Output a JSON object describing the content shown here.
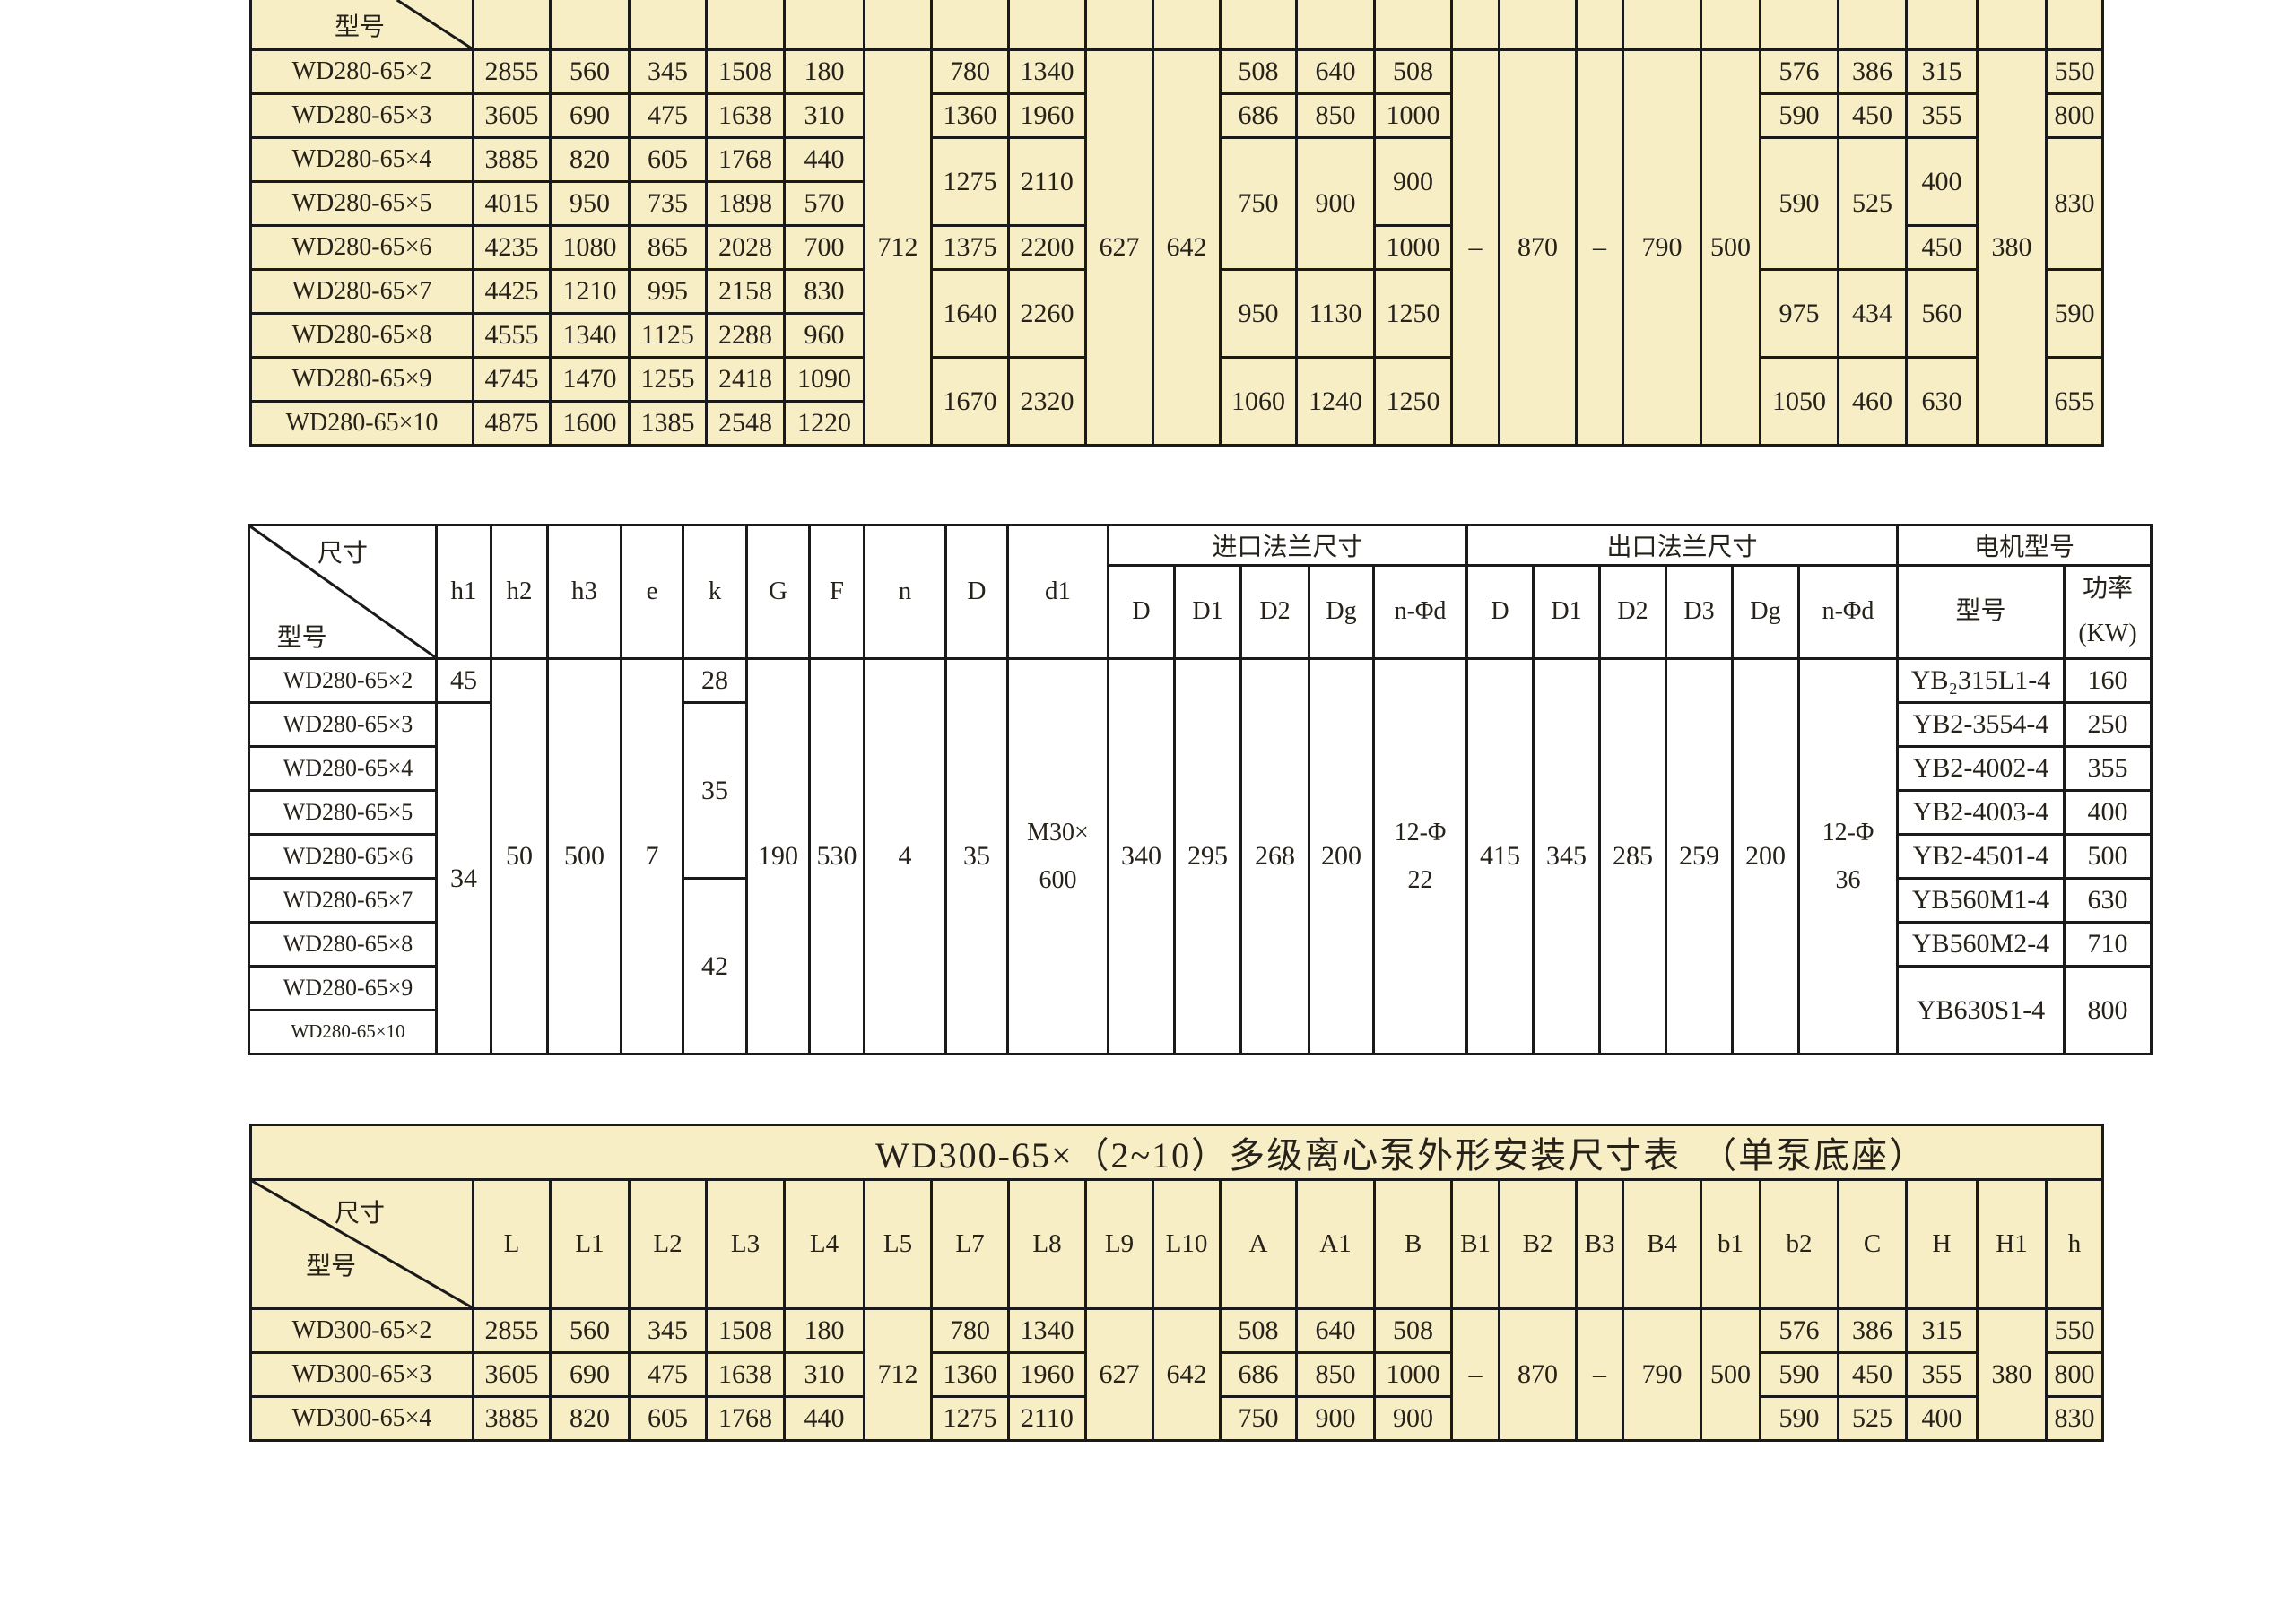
{
  "page": {
    "background": "#ffffff"
  },
  "colors": {
    "table_fill_cream": "#f7eec6",
    "table_fill_white": "#ffffff",
    "border": "#1a1a1a",
    "text": "#26221a"
  },
  "wd280_outline_table": {
    "corner_label": "型号",
    "rows": [
      {
        "model": "WD280-65×2",
        "cells": [
          [
            "2855"
          ],
          [
            "560"
          ],
          [
            "345"
          ],
          [
            "1508"
          ],
          [
            "180"
          ],
          [
            "712",
            9
          ],
          [
            "780"
          ],
          [
            "1340"
          ],
          [
            "627",
            9
          ],
          [
            "642",
            9
          ],
          [
            "508"
          ],
          [
            "640"
          ],
          [
            "508"
          ],
          [
            "–",
            9
          ],
          [
            "870",
            9
          ],
          [
            "–",
            9
          ],
          [
            "790",
            9
          ],
          [
            "500",
            9
          ],
          [
            "576"
          ],
          [
            "386"
          ],
          [
            "315"
          ],
          [
            "380",
            9
          ],
          [
            "550"
          ]
        ]
      },
      {
        "model": "WD280-65×3",
        "cells": [
          [
            "3605"
          ],
          [
            "690"
          ],
          [
            "475"
          ],
          [
            "1638"
          ],
          [
            "310"
          ],
          [
            "1360"
          ],
          [
            "1960"
          ],
          [
            "686"
          ],
          [
            "850"
          ],
          [
            "1000"
          ],
          [
            "590"
          ],
          [
            "450"
          ],
          [
            "355"
          ],
          [
            "800"
          ]
        ]
      },
      {
        "model": "WD280-65×4",
        "cells": [
          [
            "3885"
          ],
          [
            "820"
          ],
          [
            "605"
          ],
          [
            "1768"
          ],
          [
            "440"
          ],
          [
            "1275",
            2
          ],
          [
            "2110",
            2
          ],
          [
            "750",
            3
          ],
          [
            "900",
            3
          ],
          [
            "900",
            2
          ],
          [
            "590",
            3
          ],
          [
            "525",
            3
          ],
          [
            "400",
            2
          ],
          [
            "830",
            3
          ]
        ]
      },
      {
        "model": "WD280-65×5",
        "cells": [
          [
            "4015"
          ],
          [
            "950"
          ],
          [
            "735"
          ],
          [
            "1898"
          ],
          [
            "570"
          ]
        ]
      },
      {
        "model": "WD280-65×6",
        "cells": [
          [
            "4235"
          ],
          [
            "1080"
          ],
          [
            "865"
          ],
          [
            "2028"
          ],
          [
            "700"
          ],
          [
            "1375"
          ],
          [
            "2200"
          ],
          [
            "1000"
          ],
          [
            "450"
          ]
        ]
      },
      {
        "model": "WD280-65×7",
        "cells": [
          [
            "4425"
          ],
          [
            "1210"
          ],
          [
            "995"
          ],
          [
            "2158"
          ],
          [
            "830"
          ],
          [
            "1640",
            2
          ],
          [
            "2260",
            2
          ],
          [
            "950",
            2
          ],
          [
            "1130",
            2
          ],
          [
            "1250",
            2
          ],
          [
            "975",
            2
          ],
          [
            "434",
            2
          ],
          [
            "560",
            2
          ],
          [
            "590",
            2
          ]
        ]
      },
      {
        "model": "WD280-65×8",
        "cells": [
          [
            "4555"
          ],
          [
            "1340"
          ],
          [
            "1125"
          ],
          [
            "2288"
          ],
          [
            "960"
          ]
        ]
      },
      {
        "model": "WD280-65×9",
        "cells": [
          [
            "4745"
          ],
          [
            "1470"
          ],
          [
            "1255"
          ],
          [
            "2418"
          ],
          [
            "1090"
          ],
          [
            "1670",
            2
          ],
          [
            "2320",
            2
          ],
          [
            "1060",
            2
          ],
          [
            "1240",
            2
          ],
          [
            "1250",
            2
          ],
          [
            "1050",
            2
          ],
          [
            "460",
            2
          ],
          [
            "630",
            2
          ],
          [
            "655",
            2
          ]
        ]
      },
      {
        "model": "WD280-65×10",
        "cells": [
          [
            "4875"
          ],
          [
            "1600"
          ],
          [
            "1385"
          ],
          [
            "2548"
          ],
          [
            "1220"
          ]
        ]
      }
    ]
  },
  "wd280_dim_table": {
    "corner_top": "尺寸",
    "corner_bottom": "型号",
    "dim_headers": [
      "h1",
      "h2",
      "h3",
      "e",
      "k",
      "G",
      "F",
      "n",
      "D",
      "d1"
    ],
    "groups": [
      {
        "label": "进口法兰尺寸",
        "cols": [
          "D",
          "D1",
          "D2",
          "Dg",
          "n-Φd"
        ]
      },
      {
        "label": "出口法兰尺寸",
        "cols": [
          "D",
          "D1",
          "D2",
          "D3",
          "Dg",
          "n-Φd"
        ]
      },
      {
        "label": "电机型号",
        "cols": [
          "型号",
          "功率\n(KW)"
        ]
      }
    ],
    "rows": [
      {
        "model": "WD280-65×2",
        "cells": [
          [
            "45"
          ],
          [
            "50",
            9
          ],
          [
            "500",
            9
          ],
          [
            "7",
            9
          ],
          [
            "28"
          ],
          [
            "190",
            9
          ],
          [
            "530",
            9
          ],
          [
            "4",
            9
          ],
          [
            "35",
            9
          ],
          [
            "M30×\n600",
            9
          ],
          [
            "340",
            9
          ],
          [
            "295",
            9
          ],
          [
            "268",
            9
          ],
          [
            "200",
            9
          ],
          [
            "12-Φ\n22",
            9
          ],
          [
            "415",
            9
          ],
          [
            "345",
            9
          ],
          [
            "285",
            9
          ],
          [
            "259",
            9
          ],
          [
            "200",
            9
          ],
          [
            "12-Φ\n36",
            9
          ],
          [
            "YB₂315L1-4"
          ],
          [
            "160"
          ]
        ]
      },
      {
        "model": "WD280-65×3",
        "cells": [
          [
            "34",
            8
          ],
          [
            "35",
            4
          ],
          [
            "YB2-3554-4"
          ],
          [
            "250"
          ]
        ]
      },
      {
        "model": "WD280-65×4",
        "cells": [
          [
            "YB2-4002-4"
          ],
          [
            "355"
          ]
        ]
      },
      {
        "model": "WD280-65×5",
        "cells": [
          [
            "YB2-4003-4"
          ],
          [
            "400"
          ]
        ]
      },
      {
        "model": "WD280-65×6",
        "cells": [
          [
            "YB2-4501-4"
          ],
          [
            "500"
          ]
        ]
      },
      {
        "model": "WD280-65×7",
        "cells": [
          [
            "42",
            4
          ],
          [
            "YB560M1-4"
          ],
          [
            "630"
          ]
        ]
      },
      {
        "model": "WD280-65×8",
        "cells": [
          [
            "YB560M2-4"
          ],
          [
            "710"
          ]
        ]
      },
      {
        "model": "WD280-65×9",
        "cells": [
          [
            "YB630S1-4",
            2
          ],
          [
            "800",
            2
          ]
        ]
      },
      {
        "model": "WD280-65×10",
        "cells": []
      }
    ]
  },
  "wd300_outline_table": {
    "title": "WD300-65×（2~10）多级离心泵外形安装尺寸表　（单泵底座）",
    "corner_top": "尺寸",
    "corner_bottom": "型号",
    "columns": [
      "L",
      "L1",
      "L2",
      "L3",
      "L4",
      "L5",
      "L7",
      "L8",
      "L9",
      "L10",
      "A",
      "A1",
      "B",
      "B1",
      "B2",
      "B3",
      "B4",
      "b1",
      "b2",
      "C",
      "H",
      "H1",
      "h"
    ],
    "rows": [
      {
        "model": "WD300-65×2",
        "cells": [
          [
            "2855"
          ],
          [
            "560"
          ],
          [
            "345"
          ],
          [
            "1508"
          ],
          [
            "180"
          ],
          [
            "712",
            3
          ],
          [
            "780"
          ],
          [
            "1340"
          ],
          [
            "627",
            3
          ],
          [
            "642",
            3
          ],
          [
            "508"
          ],
          [
            "640"
          ],
          [
            "508"
          ],
          [
            "–",
            3
          ],
          [
            "870",
            3
          ],
          [
            "–",
            3
          ],
          [
            "790",
            3
          ],
          [
            "500",
            3
          ],
          [
            "576"
          ],
          [
            "386"
          ],
          [
            "315"
          ],
          [
            "380",
            3
          ],
          [
            "550"
          ]
        ]
      },
      {
        "model": "WD300-65×3",
        "cells": [
          [
            "3605"
          ],
          [
            "690"
          ],
          [
            "475"
          ],
          [
            "1638"
          ],
          [
            "310"
          ],
          [
            "1360"
          ],
          [
            "1960"
          ],
          [
            "686"
          ],
          [
            "850"
          ],
          [
            "1000"
          ],
          [
            "590"
          ],
          [
            "450"
          ],
          [
            "355"
          ],
          [
            "800"
          ]
        ]
      },
      {
        "model": "WD300-65×4",
        "cells": [
          [
            "3885"
          ],
          [
            "820"
          ],
          [
            "605"
          ],
          [
            "1768"
          ],
          [
            "440"
          ],
          [
            "1275"
          ],
          [
            "2110"
          ],
          [
            "750"
          ],
          [
            "900"
          ],
          [
            "900"
          ],
          [
            "590"
          ],
          [
            "525"
          ],
          [
            "400"
          ],
          [
            "830"
          ]
        ]
      }
    ]
  }
}
